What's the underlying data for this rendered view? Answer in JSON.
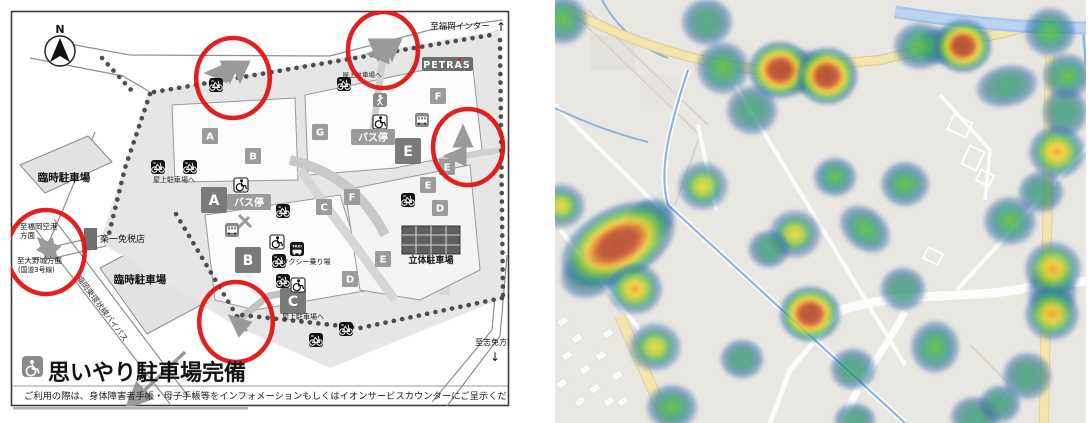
{
  "left_map": {
    "labels": {
      "compass": "N",
      "to_fukuoka_inter": "至福岡インター",
      "arrow_up": "↑",
      "petras": "PETRAS",
      "rooftop": "屋上駐車場へ",
      "temp_parking": "臨時駐車場",
      "airport1": "至福岡空港",
      "airport2": "方面",
      "onojo1": "至大野城方面",
      "onojo2": "(国道3号線)",
      "dutyfree": "楽一免税店",
      "bypass_road": "福岡東環状線バイパス",
      "bus_stop": "バス停",
      "taxi_stand": "タクシー乗り場",
      "multistory_parking": "立体駐車場",
      "to_shime": "至志免方面",
      "arrow_down": "↓",
      "heading": "思いやり駐車場完備",
      "note": "ご利用の際は、身体障害者手帳・母子手帳等をインフォメーションもしくはイオンサービスカウンターにご呈示ください。"
    },
    "tiles_large": [
      {
        "label": "A",
        "x": 214,
        "y": 200
      },
      {
        "label": "B",
        "x": 248,
        "y": 260
      },
      {
        "label": "C",
        "x": 293,
        "y": 301
      },
      {
        "label": "E",
        "x": 408,
        "y": 151
      }
    ],
    "tiles_small": [
      {
        "label": "A",
        "x": 210,
        "y": 136
      },
      {
        "label": "B",
        "x": 253,
        "y": 156
      },
      {
        "label": "G",
        "x": 320,
        "y": 132
      },
      {
        "label": "C",
        "x": 324,
        "y": 207
      },
      {
        "label": "F",
        "x": 352,
        "y": 197
      },
      {
        "label": "F",
        "x": 438,
        "y": 96
      },
      {
        "label": "E",
        "x": 447,
        "y": 167
      },
      {
        "label": "E",
        "x": 428,
        "y": 185
      },
      {
        "label": "D",
        "x": 440,
        "y": 208
      },
      {
        "label": "D",
        "x": 350,
        "y": 279
      },
      {
        "label": "E",
        "x": 383,
        "y": 259
      }
    ],
    "icons": [
      {
        "type": "bike",
        "x": 216,
        "y": 85
      },
      {
        "type": "bike",
        "x": 344,
        "y": 84
      },
      {
        "type": "bike",
        "x": 158,
        "y": 167
      },
      {
        "type": "bike",
        "x": 190,
        "y": 167
      },
      {
        "type": "bike",
        "x": 283,
        "y": 211
      },
      {
        "type": "bike",
        "x": 279,
        "y": 261
      },
      {
        "type": "bike",
        "x": 283,
        "y": 281
      },
      {
        "type": "bike",
        "x": 346,
        "y": 329
      },
      {
        "type": "bike",
        "x": 316,
        "y": 340
      },
      {
        "type": "bike",
        "x": 408,
        "y": 200
      },
      {
        "type": "wheelchair",
        "x": 241,
        "y": 185
      },
      {
        "type": "wheelchair",
        "x": 380,
        "y": 122
      },
      {
        "type": "wheelchair",
        "x": 277,
        "y": 242
      },
      {
        "type": "wheelchair",
        "x": 298,
        "y": 285
      },
      {
        "type": "bus",
        "x": 232,
        "y": 230
      },
      {
        "type": "bus",
        "x": 422,
        "y": 120
      },
      {
        "type": "taxi",
        "x": 297,
        "y": 249
      },
      {
        "type": "walk",
        "x": 380,
        "y": 100
      }
    ],
    "red_circles": [
      {
        "x": 233,
        "y": 78,
        "r": 40
      },
      {
        "x": 383,
        "y": 50,
        "r": 38
      },
      {
        "x": 468,
        "y": 147,
        "r": 38
      },
      {
        "x": 46,
        "y": 252,
        "r": 42
      },
      {
        "x": 236,
        "y": 322,
        "r": 40
      }
    ],
    "colors": {
      "highlight": "#e01414",
      "site": "#e6e6e6",
      "tile_large": "#7a7a7a",
      "tile_small": "#9b9b9b"
    }
  },
  "heatmap": {
    "colors": {
      "low": "#2a9a70",
      "mid": "#5abf2d",
      "high": "#f2d92f",
      "higher": "#f09d2a",
      "max": "#b5472b",
      "road_major": "#f2e6ac",
      "water": "#a9c7ec",
      "land": "#e9e7e1"
    },
    "blobs": [
      {
        "x": 249,
        "y": 72,
        "rx": 30,
        "ry": 24,
        "rot": 0,
        "lv": "yellow"
      },
      {
        "x": 386,
        "y": 46,
        "rx": 26,
        "ry": 20,
        "rot": 0,
        "lv": "green"
      },
      {
        "x": 497,
        "y": 292,
        "rx": 26,
        "ry": 28,
        "rot": 0,
        "lv": "teal"
      },
      {
        "x": 510,
        "y": 112,
        "rx": 24,
        "ry": 26,
        "rot": 0,
        "lv": "teal"
      },
      {
        "x": 35,
        "y": 274,
        "rx": 32,
        "ry": 25,
        "rot": -20,
        "lv": "teal"
      },
      {
        "x": 95,
        "y": 220,
        "rx": 27,
        "ry": 22,
        "rot": -30,
        "lv": "teal"
      },
      {
        "x": 63,
        "y": 244,
        "rx": 64,
        "ry": 38,
        "rot": -28,
        "lv": "red"
      },
      {
        "x": 80,
        "y": 289,
        "rx": 29,
        "ry": 27,
        "rot": 0,
        "lv": "orange"
      },
      {
        "x": 8,
        "y": 20,
        "rx": 26,
        "ry": 26,
        "rot": 0,
        "lv": "green"
      },
      {
        "x": 152,
        "y": 22,
        "rx": 27,
        "ry": 25,
        "rot": 0,
        "lv": "teal"
      },
      {
        "x": 168,
        "y": 68,
        "rx": 28,
        "ry": 28,
        "rot": 0,
        "lv": "green"
      },
      {
        "x": 225,
        "y": 70,
        "rx": 33,
        "ry": 30,
        "rot": 0,
        "lv": "red"
      },
      {
        "x": 272,
        "y": 76,
        "rx": 32,
        "ry": 30,
        "rot": 0,
        "lv": "red"
      },
      {
        "x": 197,
        "y": 110,
        "rx": 27,
        "ry": 26,
        "rot": 0,
        "lv": "teal"
      },
      {
        "x": 148,
        "y": 186,
        "rx": 27,
        "ry": 26,
        "rot": 0,
        "lv": "yellow"
      },
      {
        "x": 6,
        "y": 206,
        "rx": 26,
        "ry": 24,
        "rot": 0,
        "lv": "yellow"
      },
      {
        "x": 365,
        "y": 46,
        "rx": 28,
        "ry": 25,
        "rot": 0,
        "lv": "green"
      },
      {
        "x": 408,
        "y": 46,
        "rx": 30,
        "ry": 28,
        "rot": 0,
        "lv": "red"
      },
      {
        "x": 495,
        "y": 32,
        "rx": 27,
        "ry": 26,
        "rot": 0,
        "lv": "green"
      },
      {
        "x": 512,
        "y": 76,
        "rx": 26,
        "ry": 24,
        "rot": 0,
        "lv": "green"
      },
      {
        "x": 452,
        "y": 86,
        "rx": 33,
        "ry": 22,
        "rot": -12,
        "lv": "teal"
      },
      {
        "x": 502,
        "y": 152,
        "rx": 30,
        "ry": 28,
        "rot": 0,
        "lv": "orange"
      },
      {
        "x": 486,
        "y": 192,
        "rx": 24,
        "ry": 22,
        "rot": 0,
        "lv": "teal"
      },
      {
        "x": 280,
        "y": 177,
        "rx": 23,
        "ry": 21,
        "rot": 0,
        "lv": "green"
      },
      {
        "x": 350,
        "y": 184,
        "rx": 26,
        "ry": 24,
        "rot": 0,
        "lv": "green"
      },
      {
        "x": 240,
        "y": 234,
        "rx": 28,
        "ry": 26,
        "rot": 0,
        "lv": "yellow"
      },
      {
        "x": 214,
        "y": 249,
        "rx": 22,
        "ry": 20,
        "rot": 0,
        "lv": "teal"
      },
      {
        "x": 255,
        "y": 314,
        "rx": 32,
        "ry": 29,
        "rot": 0,
        "lv": "red"
      },
      {
        "x": 100,
        "y": 347,
        "rx": 28,
        "ry": 26,
        "rot": 0,
        "lv": "yellow"
      },
      {
        "x": 187,
        "y": 359,
        "rx": 23,
        "ry": 21,
        "rot": 0,
        "lv": "teal"
      },
      {
        "x": 117,
        "y": 407,
        "rx": 27,
        "ry": 24,
        "rot": 0,
        "lv": "green"
      },
      {
        "x": 310,
        "y": 229,
        "rx": 30,
        "ry": 22,
        "rot": 40,
        "lv": "green"
      },
      {
        "x": 348,
        "y": 289,
        "rx": 24,
        "ry": 23,
        "rot": 0,
        "lv": "teal"
      },
      {
        "x": 380,
        "y": 347,
        "rx": 26,
        "ry": 28,
        "rot": 0,
        "lv": "green"
      },
      {
        "x": 298,
        "y": 369,
        "rx": 24,
        "ry": 22,
        "rot": 0,
        "lv": "teal"
      },
      {
        "x": 455,
        "y": 221,
        "rx": 28,
        "ry": 26,
        "rot": 0,
        "lv": "green"
      },
      {
        "x": 498,
        "y": 269,
        "rx": 30,
        "ry": 29,
        "rot": 0,
        "lv": "orange"
      },
      {
        "x": 497,
        "y": 314,
        "rx": 29,
        "ry": 28,
        "rot": 0,
        "lv": "orange"
      },
      {
        "x": 472,
        "y": 376,
        "rx": 26,
        "ry": 25,
        "rot": 0,
        "lv": "teal"
      },
      {
        "x": 420,
        "y": 417,
        "rx": 26,
        "ry": 22,
        "rot": 0,
        "lv": "teal"
      },
      {
        "x": 445,
        "y": 404,
        "rx": 22,
        "ry": 20,
        "rot": 0,
        "lv": "teal"
      },
      {
        "x": 300,
        "y": 420,
        "rx": 22,
        "ry": 18,
        "rot": 0,
        "lv": "teal"
      }
    ]
  }
}
